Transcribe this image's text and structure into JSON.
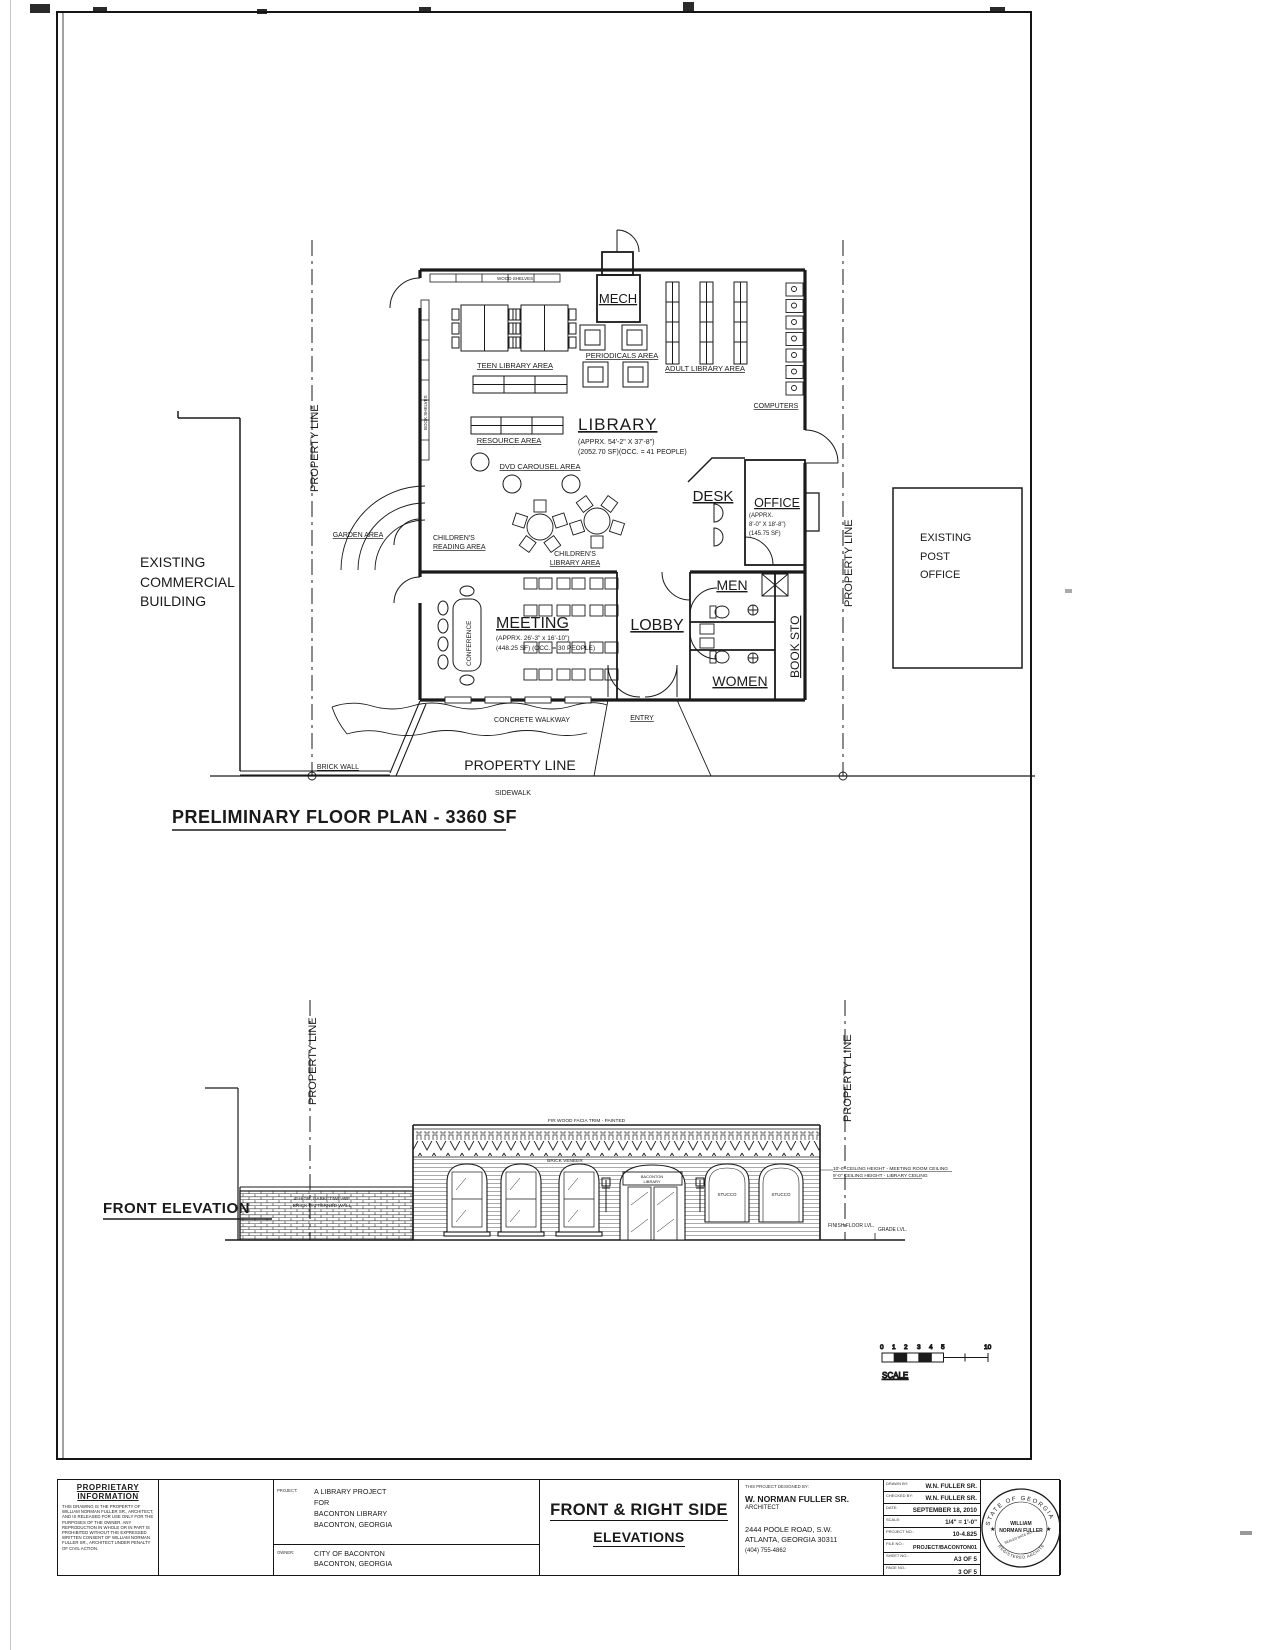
{
  "ink": "#1a1a1a",
  "paper": "#ffffff",
  "floor_plan": {
    "title": "PRELIMINARY FLOOR PLAN - 3360 SF",
    "labels": {
      "wood_shelves": "WOOD SHELVES",
      "book_shelves": "BOOK SHELVES",
      "mech": "MECH",
      "teen": "TEEN LIBRARY AREA",
      "periodicals": "PERIODICALS AREA",
      "adult": "ADULT LIBRARY AREA",
      "computers": "COMPUTERS",
      "resource": "RESOURCE AREA",
      "library": "LIBRARY",
      "library_dim": "(APPRX. 54'-2\" X 37'-8\")",
      "library_occ": "(2052.70 SF)(OCC. = 41 PEOPLE)",
      "dvd": "DVD CAROUSEL AREA",
      "garden": "GARDEN AREA",
      "childrens_reading": [
        "CHILDREN'S",
        "READING AREA"
      ],
      "childrens_library": [
        "CHILDREN'S",
        "LIBRARY AREA"
      ],
      "desk": "DESK",
      "office": "OFFICE",
      "office_dim": [
        "(APPRX.",
        "8'-0\" X 18'-8\")",
        "(145.75 SF)"
      ],
      "men": "MEN",
      "women": "WOMEN",
      "book_sto": "BOOK STO",
      "conference": "CONFERENCE",
      "meeting": "MEETING",
      "meeting_dim": "(APPRX. 26'-3\" x 16'-10\")",
      "meeting_occ": "(448.25 SF) (OCC. = 30 PEOPLE)",
      "lobby": "LOBBY",
      "entry": "ENTRY",
      "concrete_walkway": "CONCRETE WALKWAY",
      "brick_wall": "BRICK WALL",
      "property_line": "PROPERTY LINE",
      "sidewalk": "SIDEWALK",
      "existing_commercial": [
        "EXISTING",
        "COMMERCIAL",
        "BUILDING"
      ],
      "existing_post_office": [
        "EXISTING",
        "POST",
        "OFFICE"
      ]
    }
  },
  "elevation": {
    "title": "FRONT ELEVATION",
    "labels": {
      "property_line": "PROPERTY LINE",
      "facia_note": "FIR WOOD FACIA TRIM - PAINTED",
      "brick_veneer": "BRICK VENEER",
      "wall_note": [
        "4' HIGH, BASKET WEAVE",
        "BRICK PATTERNED WALL"
      ],
      "sign": [
        "BACONTON",
        "LIBRARY"
      ],
      "stucco": "STUCCO",
      "ceiling_note_1": "10'-0\" CEILING HEIGHT - MEETING ROOM CEILING",
      "ceiling_note_2": "9'-0\" CEILING HEIGHT - LIBRARY CEILING",
      "finish_floor": "FINISH FLOOR LVL.",
      "grade": "GRADE LVL."
    }
  },
  "scale_bar": {
    "numbers": [
      "0",
      "1",
      "2",
      "3",
      "4",
      "5"
    ],
    "end": "10",
    "label": "SCALE"
  },
  "title_block": {
    "proprietary": {
      "title1": "PROPRIETARY",
      "title2": "INFORMATION",
      "body": "THIS DRAWING IS THE PROPERTY OF WILLIAM NORMAN FULLER SR., ARCHITECT, AND IS RELEASED FOR USE ONLY FOR THE PURPOSES OF THE OWNER. ANY REPRODUCTION IN WHOLE OR IN PART IS PROHIBITED WITHOUT THE EXPRESSED WRITTEN CONSENT OF WILLIAM NORMAN FULLER SR., ARCHITECT UNDER PENALTY OF CIVIL ACTION."
    },
    "project_label": "PROJECT:",
    "project_lines": [
      "A LIBRARY PROJECT",
      "FOR",
      "BACONTON LIBRARY",
      "BACONTON, GEORGIA"
    ],
    "owner_label": "OWNER:",
    "owner_lines": [
      "CITY OF BACONTON",
      "BACONTON, GEORGIA"
    ],
    "sheet_title": [
      "FRONT & RIGHT SIDE",
      "ELEVATIONS"
    ],
    "designed_by_label": "THIS PROJECT DESIGNED BY:",
    "architect_name": "W. NORMAN FULLER SR.",
    "architect_title": "ARCHITECT",
    "address": [
      "2444 POOLE ROAD, S.W.",
      "ATLANTA, GEORGIA 30311"
    ],
    "phone": "(404) 755-4862",
    "rows": [
      {
        "label": "DRAWN BY:",
        "value": "W.N. FULLER SR."
      },
      {
        "label": "CHECKED BY:",
        "value": "W.N. FULLER SR."
      },
      {
        "label": "DATE:",
        "value": "SEPTEMBER 18, 2010"
      },
      {
        "label": "SCALE:",
        "value": "1/4\" = 1'-0\""
      },
      {
        "label": "PROJECT NO.:",
        "value": "10-4.825"
      },
      {
        "label": "FILE NO.:",
        "value": "PROJECT/BACONTON01"
      },
      {
        "label": "SHEET NO.:",
        "value": "A3 OF 5"
      },
      {
        "label": "PAGE NO.:",
        "value": "3 OF 5"
      }
    ],
    "seal": {
      "arc_top": "STATE OF GEORGIA",
      "name1": "WILLIAM",
      "name2": "NORMAN FULLER",
      "band": "SEALED DATE NO.",
      "arc_bottom": "REGISTERED ARCHITECT",
      "star": "★"
    }
  }
}
